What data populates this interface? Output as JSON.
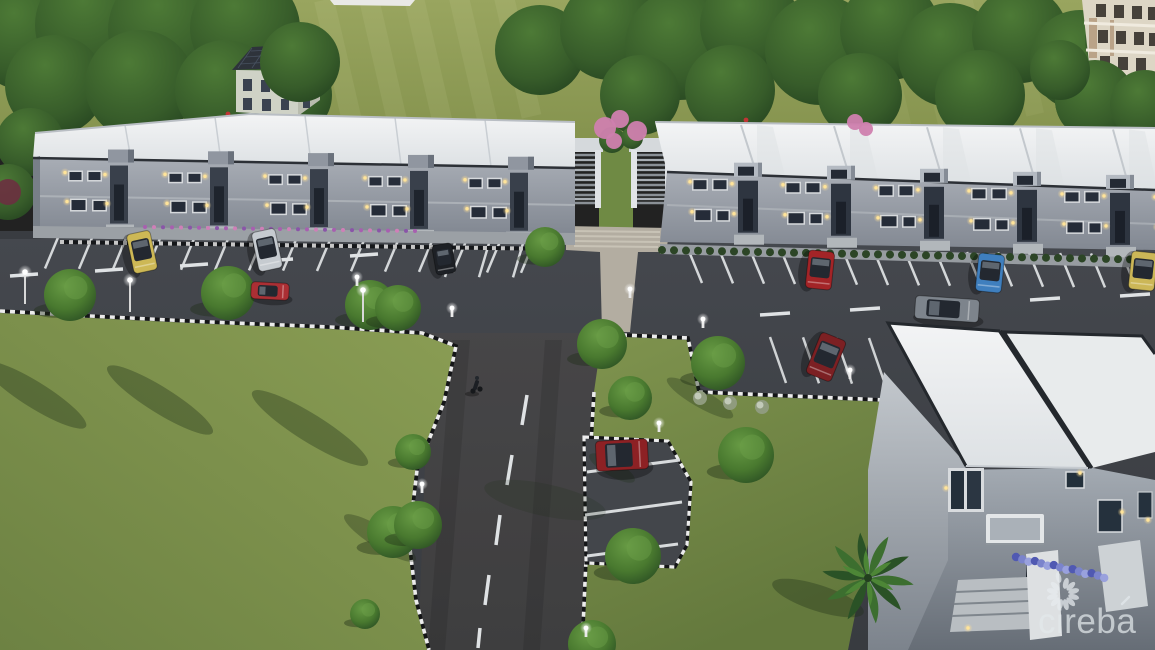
{
  "image": {
    "type": "architectural-3d-rendering",
    "time_of_day": "dusk",
    "description": "Aerial rendering of a two-row townhouse development with angled parking, central access road, lawns, trees and a foreground apartment building"
  },
  "watermark": {
    "text": "cireba",
    "accent_mark": "´",
    "logo": "petal-ring-flower-logo",
    "color": "#e3e9ec"
  },
  "palette": {
    "field": "#8d9a57",
    "grass": "#7d914d",
    "asphalt": "#3e4147",
    "access_road_tint": "#60503e",
    "roof_white": "#edeff0",
    "facade_gray": "#9aa1a9",
    "facade_dark": "#39404b",
    "window_glass": "#242b35",
    "window_lit": "#ffe49a",
    "stripe_white": "#d8dbdd",
    "curb_dark": "#141517",
    "curb_light": "#ececec",
    "tree_green": "#3f6b33",
    "tree_highlight": "#5b8c3f",
    "pink_blossom": "#cf7fae",
    "flower_purple": "#a85fb0",
    "flower_blue": "#6a74c4",
    "walkway": "#b3ada1"
  },
  "buildings": {
    "left_row": {
      "name": "left-townhouse-row",
      "units": 5,
      "stories": 2,
      "roof": "white",
      "walls": "gray"
    },
    "right_row": {
      "name": "right-townhouse-row",
      "units": 6,
      "stories": 2,
      "roof": "white",
      "walls": "gray"
    },
    "foreground": {
      "name": "foreground-building",
      "stories": 2,
      "roof": "white-flat"
    },
    "background_house": {
      "name": "background-house",
      "roof": "dark-gable-with-solar-panels"
    },
    "background_block": {
      "name": "background-apartment-block",
      "walls": "cream"
    }
  },
  "parking": {
    "left_spaces": 15,
    "left_lower_spaces": 3,
    "right_spaces": 16,
    "right_lower_spaces": 4,
    "bay_spaces": 3
  },
  "cars": [
    {
      "name": "yellow-van",
      "hex": "#cdb855",
      "x": 142,
      "y": 252,
      "w": 40,
      "h": 24,
      "rot": 78,
      "state": "parked"
    },
    {
      "name": "silver-minivan",
      "hex": "#c6cbd0",
      "x": 267,
      "y": 250,
      "w": 40,
      "h": 24,
      "rot": 78,
      "state": "parked"
    },
    {
      "name": "dark-sedan",
      "hex": "#1d2025",
      "x": 444,
      "y": 259,
      "w": 30,
      "h": 20,
      "rot": 80,
      "state": "parked"
    },
    {
      "name": "red-car",
      "hex": "#ab2f34",
      "x": 270,
      "y": 291,
      "w": 38,
      "h": 17,
      "rot": 3,
      "state": "driving"
    },
    {
      "name": "red-suv",
      "hex": "#a32427",
      "x": 820,
      "y": 270,
      "w": 38,
      "h": 26,
      "rot": 96,
      "state": "parked"
    },
    {
      "name": "blue-hatchback",
      "hex": "#3f7fbe",
      "x": 990,
      "y": 273,
      "w": 38,
      "h": 26,
      "rot": 96,
      "state": "parked"
    },
    {
      "name": "yellow-van-right",
      "hex": "#ccb757",
      "x": 1143,
      "y": 271,
      "w": 38,
      "h": 26,
      "rot": 96,
      "state": "parked"
    },
    {
      "name": "gray-sedan",
      "hex": "#7d848c",
      "x": 947,
      "y": 309,
      "w": 64,
      "h": 23,
      "rot": 4,
      "state": "driving"
    },
    {
      "name": "maroon-suv",
      "hex": "#7c2023",
      "x": 826,
      "y": 357,
      "w": 44,
      "h": 27,
      "rot": 112,
      "state": "parked"
    },
    {
      "name": "darkred-suv-bay",
      "hex": "#8d2124",
      "x": 622,
      "y": 455,
      "w": 52,
      "h": 30,
      "rot": -3,
      "state": "parked"
    }
  ],
  "cyclist": {
    "x": 476,
    "y": 388
  },
  "trees": [
    [
      70,
      295,
      26
    ],
    [
      228,
      293,
      27
    ],
    [
      370,
      305,
      25
    ],
    [
      398,
      308,
      23
    ],
    [
      545,
      247,
      20
    ],
    [
      393,
      532,
      26
    ],
    [
      365,
      614,
      15
    ],
    [
      413,
      452,
      18
    ],
    [
      418,
      525,
      24
    ],
    [
      602,
      344,
      25
    ],
    [
      630,
      398,
      22
    ],
    [
      718,
      363,
      27
    ],
    [
      746,
      455,
      28
    ],
    [
      633,
      556,
      28
    ],
    [
      592,
      644,
      24
    ]
  ],
  "background_trees": [
    [
      25,
      35,
      55
    ],
    [
      95,
      25,
      60
    ],
    [
      170,
      30,
      62
    ],
    [
      245,
      28,
      55
    ],
    [
      55,
      85,
      50
    ],
    [
      140,
      85,
      55
    ],
    [
      225,
      90,
      50
    ],
    [
      290,
      95,
      42
    ],
    [
      540,
      50,
      45
    ],
    [
      610,
      30,
      50
    ],
    [
      680,
      45,
      55
    ],
    [
      750,
      25,
      50
    ],
    [
      820,
      50,
      55
    ],
    [
      890,
      30,
      50
    ],
    [
      950,
      55,
      52
    ],
    [
      1020,
      35,
      48
    ],
    [
      1080,
      60,
      50
    ],
    [
      1130,
      40,
      45
    ],
    [
      640,
      95,
      40
    ],
    [
      730,
      90,
      45
    ],
    [
      860,
      95,
      42
    ],
    [
      980,
      95,
      45
    ],
    [
      1095,
      100,
      40
    ],
    [
      1145,
      105,
      35
    ]
  ],
  "front_trees": [
    [
      300,
      62,
      40
    ],
    [
      30,
      142,
      34
    ],
    [
      8,
      192,
      28
    ]
  ],
  "pink_trees": [
    [
      605,
      128,
      11
    ],
    [
      620,
      119,
      9
    ],
    [
      637,
      131,
      10
    ],
    [
      614,
      141,
      8
    ],
    [
      855,
      122,
      8
    ],
    [
      866,
      129,
      7
    ]
  ],
  "red_accents": [
    [
      228,
      114
    ],
    [
      233,
      118
    ],
    [
      746,
      120
    ]
  ],
  "white_bushes": [
    [
      700,
      398
    ],
    [
      730,
      403
    ],
    [
      762,
      407
    ]
  ],
  "lamps_tall": [
    [
      25,
      272
    ],
    [
      130,
      280
    ],
    [
      363,
      290
    ]
  ],
  "lamps_bollard": [
    [
      357,
      285
    ],
    [
      452,
      316
    ],
    [
      630,
      297
    ],
    [
      422,
      492
    ],
    [
      586,
      636
    ],
    [
      659,
      431
    ],
    [
      703,
      327
    ],
    [
      850,
      378
    ]
  ],
  "tree_shadows": [
    [
      35,
      395,
      60,
      13,
      32,
      0.35
    ],
    [
      160,
      400,
      62,
      13,
      32,
      0.35
    ],
    [
      310,
      428,
      68,
      14,
      32,
      0.35
    ],
    [
      380,
      538,
      42,
      10,
      32,
      0.32
    ],
    [
      545,
      500,
      16,
      62,
      -78,
      0.18
    ],
    [
      700,
      398,
      38,
      9,
      30,
      0.3
    ],
    [
      612,
      468,
      26,
      8,
      30,
      0.28
    ],
    [
      818,
      598,
      48,
      13,
      18,
      0.35
    ]
  ],
  "fg_sconces": [
    [
      946,
      488
    ],
    [
      1080,
      473
    ],
    [
      1122,
      512
    ],
    [
      968,
      628
    ],
    [
      1148,
      520
    ]
  ],
  "palm": {
    "x": 868,
    "y": 578,
    "fronds": 10
  }
}
